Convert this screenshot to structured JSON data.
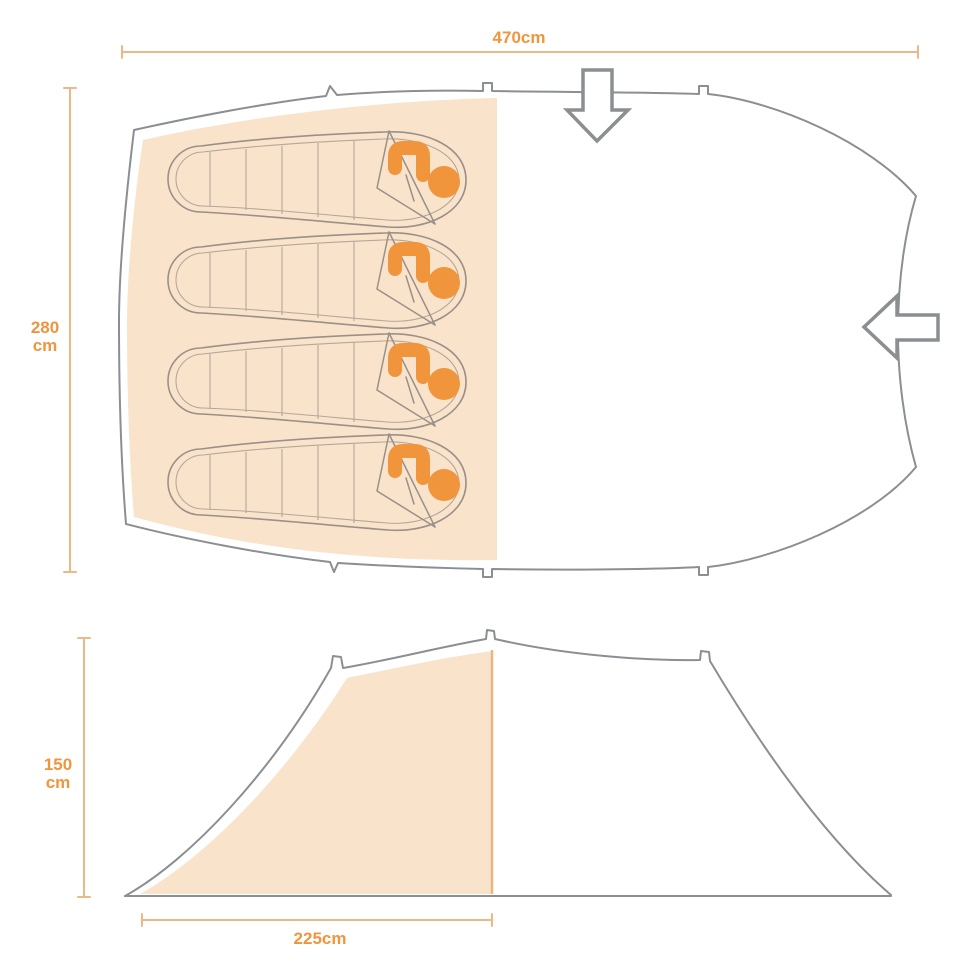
{
  "page": {
    "background": "#ffffff"
  },
  "colors": {
    "outline": "#8b8f92",
    "bag-outline": "#9a9089",
    "bag-inner": "#b3a89a",
    "shade": "#fae3cb",
    "accent": "#f0953c",
    "dim-line": "#ecb888",
    "dim-text": "#f0953c",
    "shade-edge": "#e8b584",
    "bg": "#ffffff"
  },
  "labels": {
    "total_length": "470cm",
    "total_width_value": "280",
    "total_width_unit": "cm",
    "height_value": "150",
    "height_unit": "cm",
    "bedroom_length": "225cm"
  },
  "measurements_cm": {
    "total_length": 470,
    "total_width": 280,
    "height": 150,
    "bedroom_length": 225
  },
  "views": {
    "top_view": {
      "name": "tent floor plan (top view)",
      "sleeping_bag_count": 4,
      "entrances": [
        "front entrance (top, arrow down)",
        "side entrance (right, arrow left)"
      ]
    },
    "side_view": {
      "name": "tent profile (side view)",
      "shaded_section": "bedroom compartment"
    }
  },
  "icons": {
    "front_entrance": "arrow-down-icon",
    "side_entrance": "arrow-left-icon"
  }
}
